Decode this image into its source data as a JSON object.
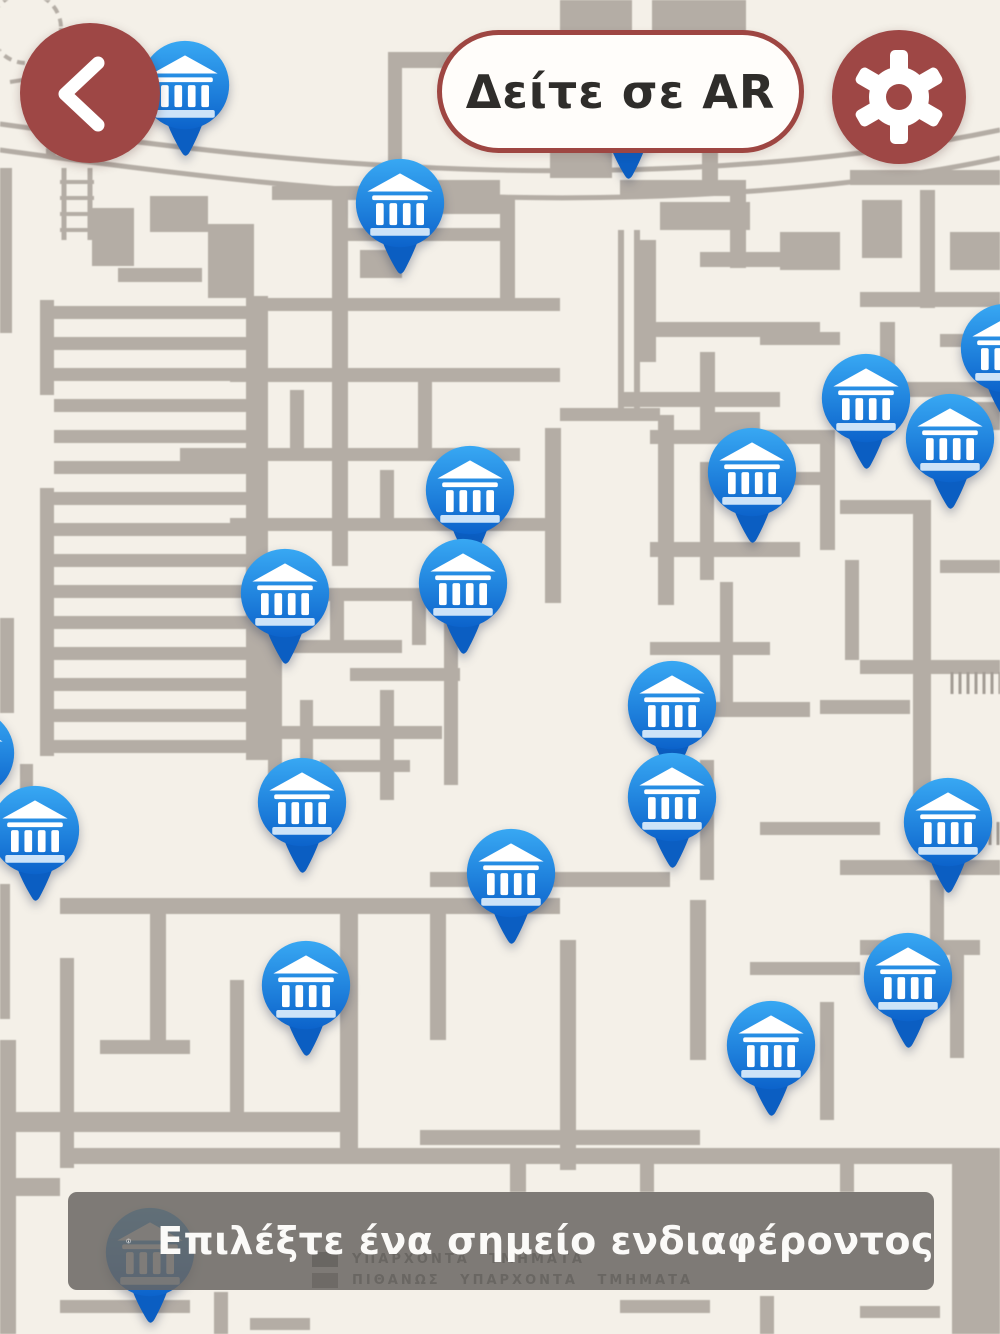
{
  "header": {
    "back_button": {
      "icon": "chevron-left"
    },
    "ar_button": {
      "label": "Δείτε σε AR"
    },
    "settings_button": {
      "icon": "gear"
    }
  },
  "map": {
    "marker_icon": "museum-landmark",
    "markers": [
      {
        "x": 185,
        "y": 85
      },
      {
        "x": 400,
        "y": 203
      },
      {
        "x": 628,
        "y": 108
      },
      {
        "x": 1005,
        "y": 348
      },
      {
        "x": 866,
        "y": 398
      },
      {
        "x": 950,
        "y": 438
      },
      {
        "x": 752,
        "y": 472
      },
      {
        "x": 470,
        "y": 490
      },
      {
        "x": 463,
        "y": 583
      },
      {
        "x": 285,
        "y": 593
      },
      {
        "x": 672,
        "y": 705
      },
      {
        "x": -30,
        "y": 753
      },
      {
        "x": 672,
        "y": 797
      },
      {
        "x": 302,
        "y": 802
      },
      {
        "x": 948,
        "y": 822
      },
      {
        "x": 35,
        "y": 830
      },
      {
        "x": 511,
        "y": 873
      },
      {
        "x": 908,
        "y": 977
      },
      {
        "x": 306,
        "y": 985
      },
      {
        "x": 771,
        "y": 1045
      },
      {
        "x": 150,
        "y": 1252
      }
    ],
    "legend": [
      {
        "label": "ΥΠΑΡΧΟΝΤΑ ΤΜΗΜΑΤΑ"
      },
      {
        "label": "ΠΙΘΑΝΩΣ ΥΠΑΡΧΟΝΤΑ ΤΜΗΜΑΤΑ"
      }
    ]
  },
  "footer_banner": {
    "icon": "info",
    "message": "Επιλέξτε ένα σημείο ενδιαφέροντος"
  },
  "colors": {
    "accent_maroon": "#9e4745",
    "marker_blue_top": "#38a8f3",
    "marker_blue_bottom": "#0c63cb",
    "marker_tail": "#0b5ec2",
    "map_wall": "#b4ada5",
    "map_background": "#f4f0e8",
    "banner_gray": "rgba(104,101,97,0.85)",
    "text_dark": "#2f2d2a",
    "text_light": "#fbfaf8"
  }
}
